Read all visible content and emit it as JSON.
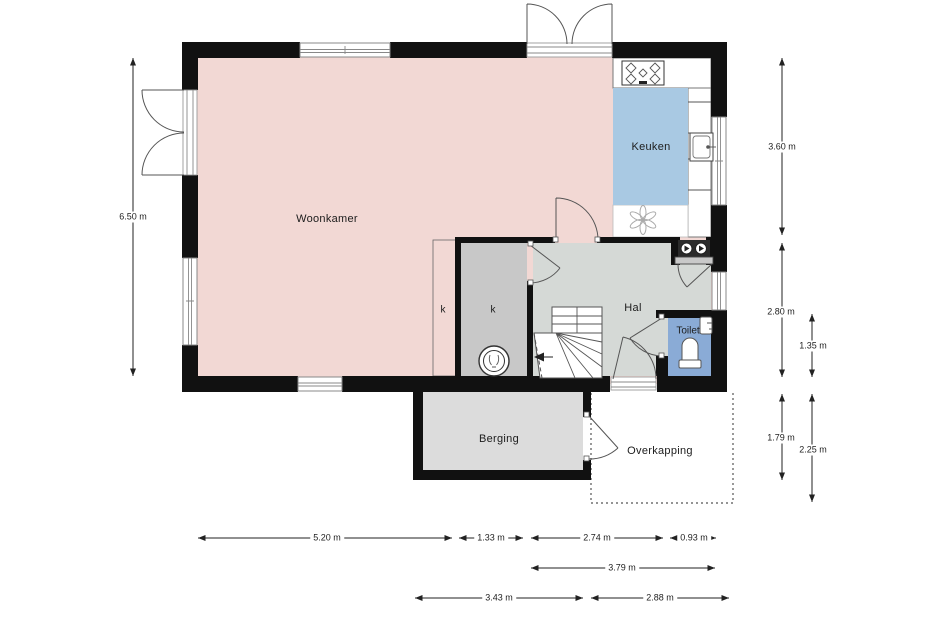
{
  "plan": {
    "type": "floor-plan",
    "rooms": {
      "woonkamer": "Woonkamer",
      "keuken": "Keuken",
      "hal": "Hal",
      "toilet": "Toilet",
      "berging": "Berging",
      "overkapping": "Overkapping",
      "closet_left": "k",
      "closet_right": "k"
    },
    "colors": {
      "woonkamer_floor": "#f2d8d4",
      "keuken_floor": "#a9c9e3",
      "hal_floor": "#d5d9d6",
      "closet_floor": "#c8c8c8",
      "toilet_floor": "#8aabd6",
      "berging_floor": "#dcdcdc",
      "wall": "#111111"
    },
    "symbols": [
      "stove-icon",
      "sink-icon",
      "extractor-fan-icon",
      "boiler-icon",
      "washer-dryer-icon",
      "stairs-icon",
      "toilet-icon",
      "hand-basin-icon"
    ]
  },
  "dimensions": {
    "left": "6.50 m",
    "right_col_a": [
      "3.60 m",
      "2.80 m",
      "1.79 m"
    ],
    "right_col_b": [
      "1.35 m",
      "2.25 m"
    ],
    "bottom_row1": [
      "5.20 m",
      "1.33 m",
      "2.74 m",
      "0.93 m"
    ],
    "bottom_row2": [
      "3.79 m"
    ],
    "bottom_row3": [
      "3.43 m",
      "2.88 m"
    ]
  }
}
